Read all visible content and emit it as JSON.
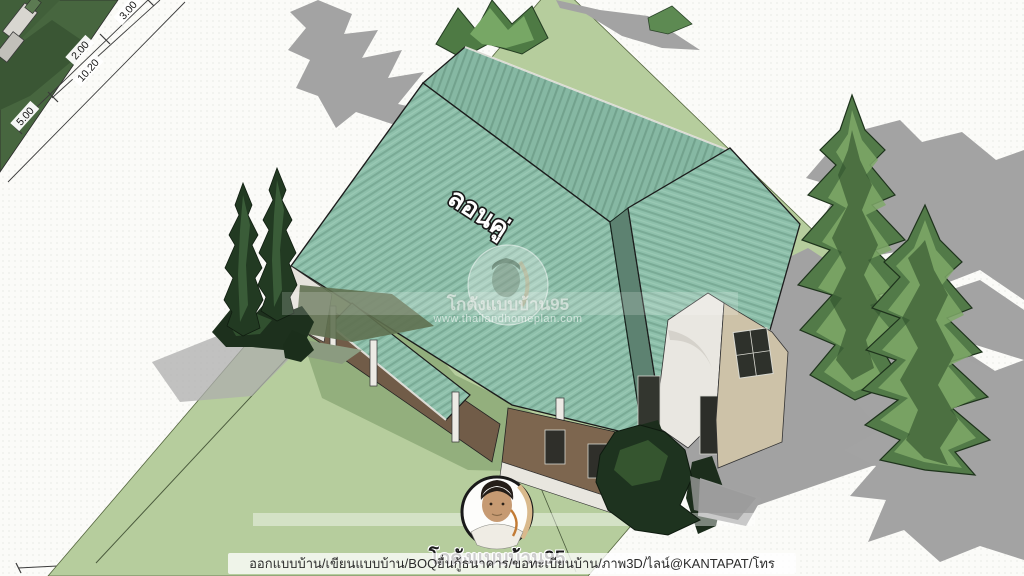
{
  "roof": {
    "material_label": "ลอนคู่"
  },
  "watermark": {
    "title": "โกดังแบบบ้าน95",
    "website": "www.thailandhomeplan.com"
  },
  "branding": {
    "name": "โกดังแบบบ้าน95",
    "services": "ออกแบบบ้าน/เขียนแบบบ้าน/BOQยื่นกู้ธนาคาร/ขอทะเบียนบ้าน/ภาพ3D/ไลน์@KANTAPAT/โทร 0994071584"
  },
  "dimensions": {
    "a": "5.00",
    "b": "10.20",
    "c": "2.00",
    "d": "3.00"
  },
  "colors": {
    "roof_teal": "#8ec0ab",
    "roof_stripe": "#79a995",
    "roof_valley": "#5d8271",
    "lawn": "#b6cd9d",
    "lawn_shadow": "#93af7d",
    "neighbor_grass": "#47663f",
    "shadow_gray": "#a2a2a2",
    "wall_tan": "#cdc2a8",
    "wall_white": "#e9e7e1",
    "porch_brown": "#715c48"
  }
}
